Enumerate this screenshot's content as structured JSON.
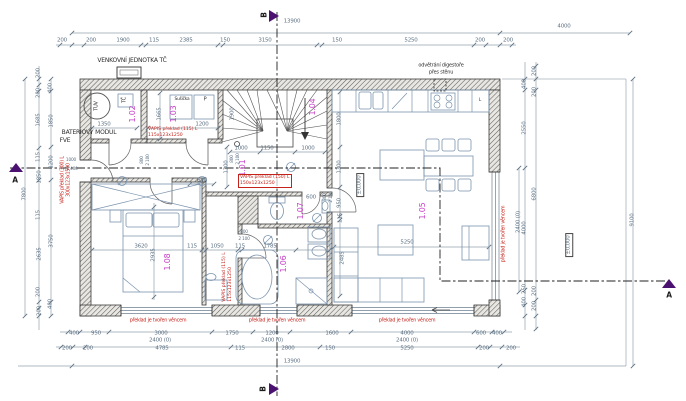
{
  "plan": {
    "top": {
      "total": "13900",
      "ext": "4000",
      "row": [
        "200",
        "200",
        "1900",
        "115",
        "2385",
        "150",
        "3150",
        "150",
        "5250",
        "200",
        "200"
      ]
    },
    "left": {
      "total": "7800",
      "outer": [
        "200",
        "200",
        "1685",
        "115",
        "1850",
        "115",
        "2635",
        "200",
        "200"
      ],
      "inner": [
        "400",
        "1850",
        "1200",
        "3750",
        "400"
      ],
      "battery1": "BATERIOVÝ MODUL",
      "battery2": "FVE"
    },
    "right": {
      "total": "9100",
      "inner": [
        "400",
        "2550",
        "4000",
        "250",
        "400"
      ],
      "outer": [
        "200",
        "200",
        "6800",
        "200",
        "200"
      ],
      "win": "2400 (0)"
    },
    "bottom": {
      "row1": [
        "400",
        "950",
        "3000",
        "1750",
        "1200",
        "1600",
        "4000",
        "600",
        "400"
      ],
      "row1b": [
        "2400 (0)",
        "2400 (0)",
        "2400 (0)"
      ],
      "row2": [
        "200",
        "200",
        "4785",
        "115",
        "2800",
        "150",
        "5250",
        "200",
        "200"
      ],
      "total": "13900"
    },
    "rooms": {
      "r101": "1.01",
      "r102": "1.02",
      "r103": "1.03",
      "r104": "1.04",
      "r105": "1.05",
      "r106": "1.06",
      "r107": "1.07",
      "r108": "1.08"
    },
    "labels": {
      "outdoor_unit": "VENKOVNÍ JEDNOTKA TČ",
      "vent1": "odvětrání digestoře",
      "vent2": "přes stěnu",
      "tuv": "TUV",
      "tc": "TČ",
      "dryer": "Sušička",
      "p": "P",
      "fridge": "L",
      "level": "±0,000"
    },
    "notes": {
      "vapis115_1": "VAPIS překlad (115) L",
      "vapis115_2": "115x123x1250",
      "vapis150_1": "VAPIS překlad (150) L",
      "vapis150_2": "150x123x1250",
      "vapis300_1": "VAPIS překlad (300) L",
      "vapis300_2": "300x123x1500",
      "lintel": "překlad je tvořen věncem"
    },
    "interior": {
      "d1350": "1350",
      "d1200": "1200",
      "d1665": "1665",
      "d1900": "1900",
      "stair": [
        "1000",
        "1150",
        "1000"
      ],
      "d1300": "1300",
      "d1800": "1800",
      "d640": "640",
      "d600": "600",
      "d800": "800",
      "d2100": "2 100",
      "d1000": "1000",
      "d2400": "2 400",
      "bedrow": [
        "3620",
        "115",
        "1050",
        "115",
        "1785"
      ],
      "d2935": "2935",
      "d5250": "5250",
      "d950": "950",
      "d115": "115",
      "d2485": "2485"
    },
    "sections": {
      "a": "A",
      "b": "B"
    }
  }
}
